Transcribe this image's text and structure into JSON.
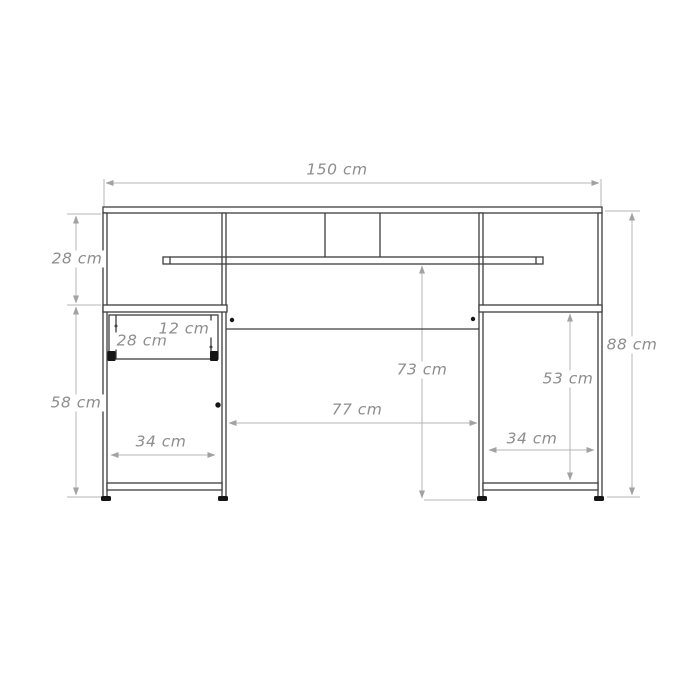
{
  "diagram": {
    "type": "furniture-dimension-drawing",
    "subject": "desk front elevation with dimensions",
    "unit": "cm",
    "labels": {
      "total_width": "150 cm",
      "hutch_height": "28 cm",
      "lower_left_height": "58 cm",
      "total_height": "88 cm",
      "shelf_to_floor": "73 cm",
      "middle_opening_width": "77 cm",
      "right_cabinet_inner_height": "53 cm",
      "left_cabinet_width": "34 cm",
      "right_cabinet_width": "34 cm",
      "drawer_width": "28 cm",
      "drawer_height": "12 cm"
    },
    "dimensions_cm": {
      "total_width": 150,
      "hutch_height": 28,
      "lower_left_height": 58,
      "total_height": 88,
      "shelf_to_floor": 73,
      "middle_opening_width": 77,
      "right_cabinet_inner_height": 53,
      "left_cabinet_width": 34,
      "right_cabinet_width": 34,
      "drawer_width": 28,
      "drawer_height": 12
    },
    "colors": {
      "background": "#ffffff",
      "furniture_line": "#3d3d3d",
      "dimension_line": "#b6b6b6",
      "dimension_text": "#8d8d8d",
      "hardware_black": "#151515"
    }
  }
}
